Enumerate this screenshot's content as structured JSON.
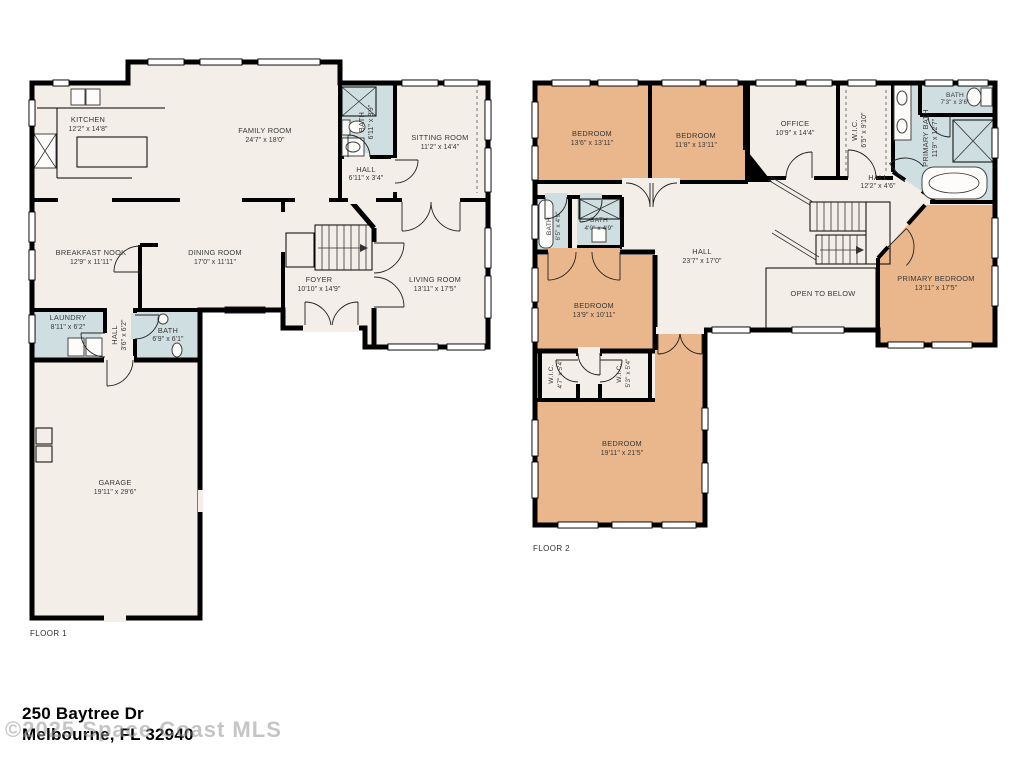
{
  "floor1": {
    "label": "FLOOR 1",
    "rooms": {
      "kitchen": {
        "name": "KITCHEN",
        "dims": "12'2\" x 14'8\""
      },
      "family_room": {
        "name": "FAMILY ROOM",
        "dims": "24'7\" x 18'0\""
      },
      "bath": {
        "name": "BATH",
        "dims": "6'11\" x 8'9\""
      },
      "sitting_room": {
        "name": "SITTING ROOM",
        "dims": "11'2\" x 14'4\""
      },
      "hall_upper": {
        "name": "HALL",
        "dims": "6'11\" x 3'4\""
      },
      "breakfast_nook": {
        "name": "BREAKFAST NOOK",
        "dims": "12'9\" x 11'11\""
      },
      "dining_room": {
        "name": "DINING ROOM",
        "dims": "17'0\" x 11'11\""
      },
      "foyer": {
        "name": "FOYER",
        "dims": "10'10\" x 14'9\""
      },
      "living_room": {
        "name": "LIVING ROOM",
        "dims": "13'11\" x 17'5\""
      },
      "laundry": {
        "name": "LAUNDRY",
        "dims": "8'11\" x 6'2\""
      },
      "hall_lower": {
        "name": "HALL",
        "dims": "3'6\" x 6'2\""
      },
      "bath_lower": {
        "name": "BATH",
        "dims": "6'9\" x 6'1\""
      },
      "garage": {
        "name": "GARAGE",
        "dims": "19'11\" x 29'6\""
      }
    }
  },
  "floor2": {
    "label": "FLOOR 2",
    "rooms": {
      "bedroom_1": {
        "name": "BEDROOM",
        "dims": "13'6\" x 13'11\""
      },
      "bedroom_2": {
        "name": "BEDROOM",
        "dims": "11'8\" x 13'11\""
      },
      "office": {
        "name": "OFFICE",
        "dims": "10'9\" x 14'4\""
      },
      "wic_top": {
        "name": "W.I.C.",
        "dims": "6'5\" x 9'10\""
      },
      "bath_top": {
        "name": "BATH",
        "dims": "7'3\" x 3'6\""
      },
      "primary_bath": {
        "name": "PRIMARY BATH",
        "dims": "11'9\" x 12'7\""
      },
      "hall_upper": {
        "name": "HALL",
        "dims": "12'2\" x 4'6\""
      },
      "bath_left": {
        "name": "BATH",
        "dims": "6'5\" x 4'9\""
      },
      "bath_mid": {
        "name": "BATH",
        "dims": "4'0\" x 4'9\""
      },
      "hall_main": {
        "name": "HALL",
        "dims": "23'7\" x 17'0\""
      },
      "open_to_below": {
        "name": "OPEN TO BELOW"
      },
      "primary_bedroom": {
        "name": "PRIMARY BEDROOM",
        "dims": "13'11\" x 17'5\""
      },
      "bedroom_3": {
        "name": "BEDROOM",
        "dims": "13'9\" x 10'11\""
      },
      "wic_left": {
        "name": "W.I.C.",
        "dims": "4'7\" x 5'4\""
      },
      "wic_right": {
        "name": "W.I.C.",
        "dims": "5'3\" x 5'4\""
      },
      "bedroom_4": {
        "name": "BEDROOM",
        "dims": "19'11\" x 21'5\""
      }
    }
  },
  "footer": {
    "address_line1": "250 Baytree Dr",
    "address_line2": "Melbourne, FL 32940",
    "watermark": "©2025 Space Coast MLS"
  },
  "colors": {
    "floor": "#f3eee8",
    "bedroom": "#eab78c",
    "bath": "#cfdfe1",
    "wall": "#000000",
    "label_text": "#383838"
  }
}
